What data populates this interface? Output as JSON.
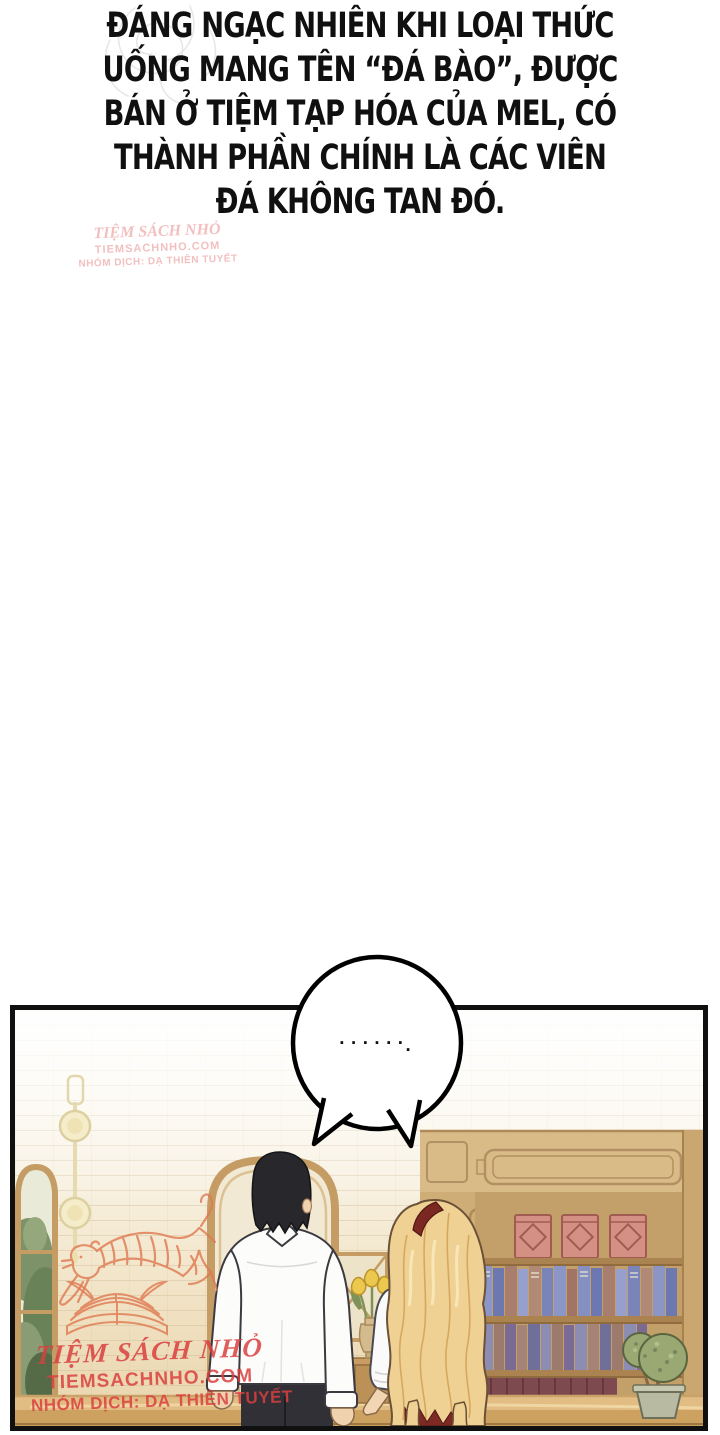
{
  "narration": {
    "lines": [
      "ĐÁNG NGẠC NHIÊN KHI LOẠI THỨC",
      "UỐNG MANG TÊN “ĐÁ BÀO”, ĐƯỢC",
      "BÁN Ở TIỆM TẠP HÓA CỦA MEL, CÓ",
      "THÀNH PHẦN CHÍNH LÀ CÁC VIÊN",
      "ĐÁ KHÔNG TAN ĐÓ."
    ]
  },
  "speech_bubble": {
    "dots": "......",
    "period": "."
  },
  "watermark_top": {
    "site_name": "TIỆM SÁCH NHỎ",
    "site_url": "TIEMSACHNHO.COM",
    "credit": "NHÓM DỊCH: DẠ THIÊN TUYẾT"
  },
  "watermark_bottom": {
    "site_name": "TIỆM SÁCH NHỎ",
    "site_url": "TIEMSACHNHO.COM",
    "credit": "NHÓM DỊCH: DẠ THIÊN TUYẾT"
  },
  "colors": {
    "ink": "#101010",
    "paper": "#ffffff",
    "watermark_red": "#d94f4f",
    "watermark_orange": "#df7950",
    "wall_cream": "#f6efdd",
    "wood_tan": "#c49c64",
    "counter_tan": "#ddb97e",
    "hair_black": "#27272c",
    "hair_blonde": "#efd193",
    "headband_red": "#7c2822",
    "dress_red": "#7c2a23",
    "shirt_white": "#fcfcfb",
    "skin": "#f0d2ae",
    "book_blue": "#8c96c6",
    "box_pink": "#d49183",
    "plant_green": "#9aa873"
  }
}
